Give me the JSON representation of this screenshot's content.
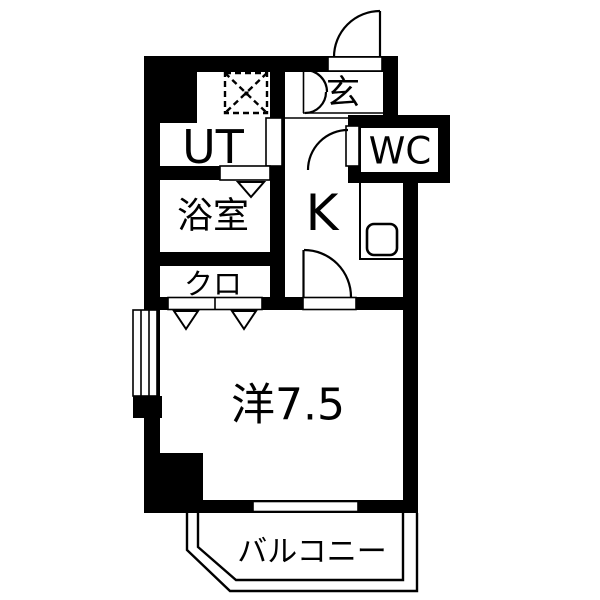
{
  "meta": {
    "type": "floor-plan",
    "background": "#ffffff",
    "wall_color": "#000000"
  },
  "rooms": {
    "genkan": {
      "label": "玄"
    },
    "utility": {
      "label": "UT"
    },
    "wc": {
      "label": "WC"
    },
    "bathroom": {
      "label": "浴室"
    },
    "kitchen": {
      "label": "K"
    },
    "closet": {
      "label": "クロ"
    },
    "western_room": {
      "label": "洋7.5"
    },
    "balcony": {
      "label": "バルコニー"
    }
  },
  "icons": {
    "washer_pan": "dashed-square-x",
    "kitchen_sink": "rounded-square",
    "swing_door": "quarter-arc",
    "folding_door": "v-triangle",
    "window": "double-line-rect",
    "balcony_rail": "double-outline"
  }
}
